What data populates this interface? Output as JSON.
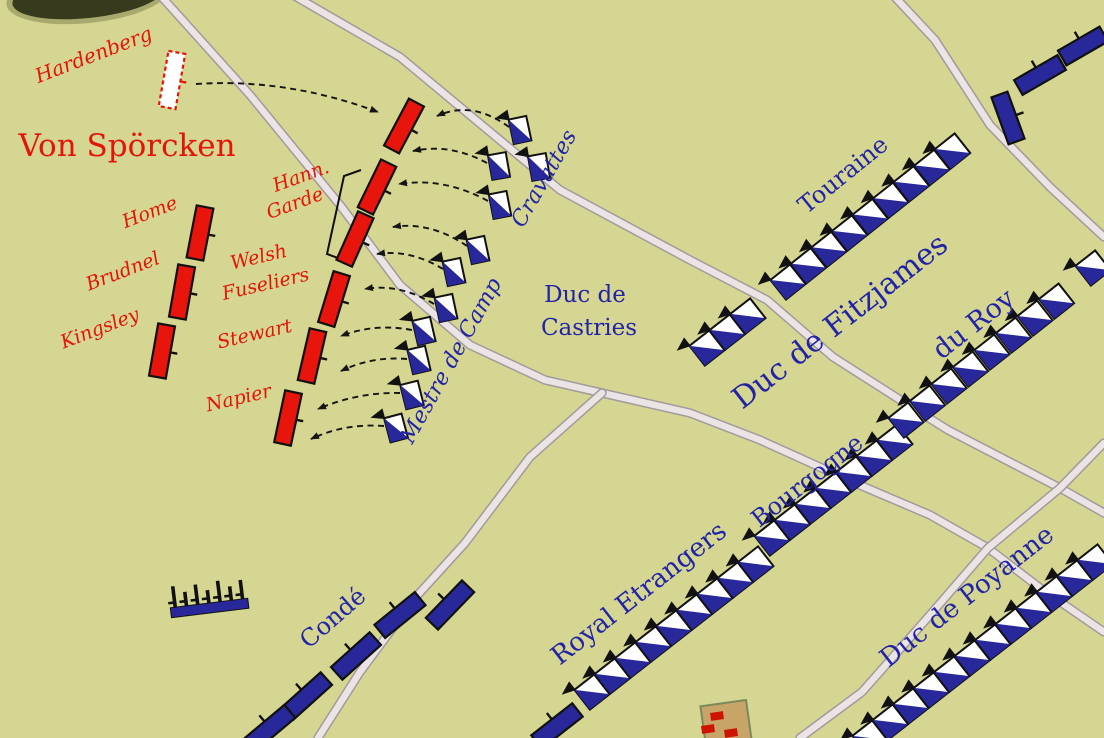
{
  "map": {
    "width": 1104,
    "height": 738,
    "colors": {
      "background": "#d4d691",
      "road_fill": "#ebe4e4",
      "road_edge": "#a29a9c",
      "red_unit": "#e8150c",
      "blue_unit": "#28289b",
      "red_text": "#e41408",
      "blue_text": "#2323a7",
      "outline": "#111111",
      "building_fill": "#c8a469",
      "building_edge": "#7a8a5a",
      "building_mark": "#cc1400",
      "woods_dark": "#373a1c",
      "woods_halo": "#8a8c55"
    },
    "roads": [
      {
        "id": "northwest",
        "points": [
          [
            160,
            -5
          ],
          [
            250,
            95
          ],
          [
            340,
            205
          ],
          [
            400,
            285
          ],
          [
            470,
            345
          ],
          [
            545,
            380
          ],
          [
            602,
            393
          ]
        ]
      },
      {
        "id": "east",
        "points": [
          [
            602,
            393
          ],
          [
            690,
            413
          ],
          [
            760,
            440
          ],
          [
            855,
            483
          ],
          [
            930,
            515
          ],
          [
            988,
            548
          ],
          [
            1040,
            588
          ],
          [
            1104,
            632
          ]
        ]
      },
      {
        "id": "south",
        "points": [
          [
            602,
            393
          ],
          [
            530,
            457
          ],
          [
            465,
            543
          ],
          [
            415,
            598
          ],
          [
            360,
            672
          ],
          [
            318,
            738
          ]
        ]
      },
      {
        "id": "middle-diagonal",
        "points": [
          [
            293,
            -5
          ],
          [
            400,
            57
          ],
          [
            560,
            190
          ],
          [
            690,
            260
          ],
          [
            767,
            300
          ],
          [
            833,
            357
          ],
          [
            905,
            403
          ],
          [
            948,
            430
          ],
          [
            1060,
            488
          ],
          [
            1104,
            513
          ]
        ]
      },
      {
        "id": "northeast",
        "points": [
          [
            893,
            -5
          ],
          [
            935,
            40
          ],
          [
            990,
            125
          ],
          [
            1050,
            187
          ],
          [
            1104,
            237
          ]
        ]
      },
      {
        "id": "southeast",
        "points": [
          [
            1104,
            443
          ],
          [
            1060,
            488
          ],
          [
            988,
            548
          ],
          [
            930,
            615
          ],
          [
            862,
            692
          ],
          [
            800,
            738
          ]
        ]
      }
    ],
    "woods_blob": {
      "cx": 88,
      "cy": -4,
      "rx": 76,
      "ry": 22,
      "angle": -6
    },
    "building": {
      "x": 726,
      "y": 723,
      "w": 46,
      "h": 40,
      "angle": -8,
      "marks": [
        {
          "x": 717,
          "y": 716,
          "w": 13,
          "h": 8,
          "angle": -8
        },
        {
          "x": 708,
          "y": 729,
          "w": 13,
          "h": 8,
          "angle": -8
        },
        {
          "x": 731,
          "y": 733,
          "w": 13,
          "h": 8,
          "angle": -8
        }
      ]
    },
    "bracket": {
      "points": "361,170 344,176 327,254 346,261"
    },
    "artillery": {
      "x": 209,
      "y": 603,
      "angle": -7,
      "bar_w": 78,
      "bar_h": 10,
      "teeth": [
        21,
        14,
        20,
        13,
        21,
        14,
        19
      ]
    },
    "units_infantry": [
      {
        "id": "hardenberg",
        "x": 172,
        "y": 80,
        "w": 17,
        "h": 56,
        "angle": 10,
        "variant": "ghost"
      },
      {
        "id": "line-north-1",
        "x": 404,
        "y": 126,
        "w": 17,
        "h": 53,
        "angle": 28,
        "variant": "red"
      },
      {
        "id": "hann-garde-1",
        "x": 377,
        "y": 187,
        "w": 17,
        "h": 53,
        "angle": 26,
        "variant": "red"
      },
      {
        "id": "hann-garde-2",
        "x": 355,
        "y": 239,
        "w": 17,
        "h": 53,
        "angle": 24,
        "variant": "red"
      },
      {
        "id": "welsh-fuseliers",
        "x": 334,
        "y": 299,
        "w": 17,
        "h": 53,
        "angle": 17,
        "variant": "red"
      },
      {
        "id": "stewart",
        "x": 312,
        "y": 356,
        "w": 17,
        "h": 53,
        "angle": 13,
        "variant": "red"
      },
      {
        "id": "napier",
        "x": 288,
        "y": 418,
        "w": 17,
        "h": 53,
        "angle": 12,
        "variant": "red"
      },
      {
        "id": "home",
        "x": 200,
        "y": 233,
        "w": 17,
        "h": 53,
        "angle": 11,
        "variant": "red"
      },
      {
        "id": "brudnel",
        "x": 182,
        "y": 292,
        "w": 17,
        "h": 53,
        "angle": 10,
        "variant": "red"
      },
      {
        "id": "kingsley",
        "x": 162,
        "y": 351,
        "w": 17,
        "h": 53,
        "angle": 10,
        "variant": "red"
      },
      {
        "id": "conde-1",
        "x": 450,
        "y": 605,
        "w": 52,
        "h": 17,
        "angle": -46,
        "variant": "blue"
      },
      {
        "id": "conde-2",
        "x": 400,
        "y": 615,
        "w": 52,
        "h": 17,
        "angle": -39,
        "variant": "blue"
      },
      {
        "id": "conde-3",
        "x": 356,
        "y": 656,
        "w": 52,
        "h": 17,
        "angle": -42,
        "variant": "blue"
      },
      {
        "id": "conde-4",
        "x": 307,
        "y": 696,
        "w": 52,
        "h": 17,
        "angle": -42,
        "variant": "blue"
      },
      {
        "id": "conde-5",
        "x": 270,
        "y": 728,
        "w": 52,
        "h": 17,
        "angle": -40,
        "variant": "blue"
      },
      {
        "id": "battalion-south",
        "x": 557,
        "y": 726,
        "w": 52,
        "h": 17,
        "angle": -38,
        "variant": "blue"
      },
      {
        "id": "northeast-1",
        "x": 1008,
        "y": 118,
        "w": 50,
        "h": 17,
        "angle": 70,
        "variant": "blue"
      },
      {
        "id": "northeast-2",
        "x": 1040,
        "y": 75,
        "w": 50,
        "h": 17,
        "angle": -30,
        "variant": "blue"
      },
      {
        "id": "northeast-3",
        "x": 1083,
        "y": 46,
        "w": 48,
        "h": 17,
        "angle": -30,
        "variant": "blue"
      }
    ],
    "cavalry_lines": [
      {
        "id": "touraine-a",
        "x": 707,
        "y": 348,
        "angle": -38,
        "count": 3,
        "spacing": 26
      },
      {
        "id": "touraine-b",
        "x": 788,
        "y": 282,
        "angle": -38.5,
        "count": 9,
        "spacing": 26.3
      },
      {
        "id": "royal-etrangers",
        "x": 592,
        "y": 692,
        "angle": -38,
        "count": 9,
        "spacing": 26
      },
      {
        "id": "bourgogne",
        "x": 772,
        "y": 538,
        "angle": -38,
        "count": 7,
        "spacing": 26
      },
      {
        "id": "du-roy",
        "x": 906,
        "y": 420,
        "angle": -38.3,
        "count": 8,
        "spacing": 27.4
      },
      {
        "id": "du-roy-b",
        "x": 1093,
        "y": 268,
        "angle": -38,
        "count": 1,
        "spacing": 26
      },
      {
        "id": "poyanne",
        "x": 870,
        "y": 738,
        "angle": -38,
        "count": 12,
        "spacing": 26
      }
    ],
    "cavalry_squadrons": [
      {
        "x": 520,
        "y": 130,
        "angle": -12
      },
      {
        "x": 539,
        "y": 167,
        "angle": -10
      },
      {
        "x": 499,
        "y": 166,
        "angle": -10
      },
      {
        "x": 500,
        "y": 205,
        "angle": -11
      },
      {
        "x": 478,
        "y": 250,
        "angle": -12
      },
      {
        "x": 454,
        "y": 272,
        "angle": -12
      },
      {
        "x": 446,
        "y": 308,
        "angle": -12
      },
      {
        "x": 424,
        "y": 331,
        "angle": -13
      },
      {
        "x": 419,
        "y": 360,
        "angle": -13
      },
      {
        "x": 412,
        "y": 395,
        "angle": -14
      },
      {
        "x": 396,
        "y": 428,
        "angle": -15
      }
    ],
    "arrows": [
      {
        "from": [
          196,
          84
        ],
        "ctrl": [
          287,
          78
        ],
        "to": [
          378,
          112
        ]
      },
      {
        "from": [
          509,
          127
        ],
        "ctrl": [
          472,
          100
        ],
        "to": [
          437,
          116
        ]
      },
      {
        "from": [
          487,
          163
        ],
        "ctrl": [
          450,
          143
        ],
        "to": [
          413,
          151
        ]
      },
      {
        "from": [
          488,
          201
        ],
        "ctrl": [
          444,
          177
        ],
        "to": [
          399,
          184
        ]
      },
      {
        "from": [
          467,
          246
        ],
        "ctrl": [
          430,
          221
        ],
        "to": [
          393,
          227
        ]
      },
      {
        "from": [
          443,
          269
        ],
        "ctrl": [
          410,
          249
        ],
        "to": [
          377,
          254
        ]
      },
      {
        "from": [
          434,
          304
        ],
        "ctrl": [
          399,
          283
        ],
        "to": [
          365,
          289
        ]
      },
      {
        "from": [
          412,
          330
        ],
        "ctrl": [
          375,
          323
        ],
        "to": [
          341,
          336
        ]
      },
      {
        "from": [
          407,
          359
        ],
        "ctrl": [
          372,
          356
        ],
        "to": [
          341,
          371
        ]
      },
      {
        "from": [
          400,
          393
        ],
        "ctrl": [
          358,
          392
        ],
        "to": [
          318,
          409
        ]
      },
      {
        "from": [
          384,
          426
        ],
        "ctrl": [
          345,
          423
        ],
        "to": [
          311,
          439
        ]
      }
    ],
    "labels": [
      {
        "id": "hardenberg",
        "text": "Hardenberg",
        "x": 96,
        "y": 61,
        "angle": -21,
        "size": 20,
        "color": "red",
        "italic": true
      },
      {
        "id": "von-spoercken",
        "text": "Von Spörcken",
        "x": 127,
        "y": 156,
        "angle": 0,
        "size": 31,
        "color": "red",
        "italic": false
      },
      {
        "id": "hann",
        "text": "Hann.",
        "x": 303,
        "y": 182,
        "angle": -20,
        "size": 19,
        "color": "red",
        "italic": true
      },
      {
        "id": "garde",
        "text": "Garde",
        "x": 297,
        "y": 209,
        "angle": -20,
        "size": 19,
        "color": "red",
        "italic": true
      },
      {
        "id": "home",
        "text": "Home",
        "x": 152,
        "y": 218,
        "angle": -21,
        "size": 19,
        "color": "red",
        "italic": true
      },
      {
        "id": "brudnel",
        "text": "Brudnel",
        "x": 125,
        "y": 277,
        "angle": -21,
        "size": 19,
        "color": "red",
        "italic": true
      },
      {
        "id": "kingsley",
        "text": "Kingsley",
        "x": 102,
        "y": 334,
        "angle": -21,
        "size": 19,
        "color": "red",
        "italic": true
      },
      {
        "id": "welsh",
        "text": "Welsh",
        "x": 260,
        "y": 263,
        "angle": -13,
        "size": 19,
        "color": "red",
        "italic": true
      },
      {
        "id": "fuseliers",
        "text": "Fuseliers",
        "x": 267,
        "y": 290,
        "angle": -13,
        "size": 19,
        "color": "red",
        "italic": true
      },
      {
        "id": "stewart",
        "text": "Stewart",
        "x": 256,
        "y": 340,
        "angle": -13,
        "size": 19,
        "color": "red",
        "italic": true
      },
      {
        "id": "napier",
        "text": "Napier",
        "x": 240,
        "y": 404,
        "angle": -13,
        "size": 19,
        "color": "red",
        "italic": true
      },
      {
        "id": "cravattes",
        "text": "Cravattes",
        "x": 550,
        "y": 182,
        "angle": -60,
        "size": 22,
        "color": "blue",
        "italic": true
      },
      {
        "id": "mestre-de-camp",
        "text": "Mestre de Camp",
        "x": 457,
        "y": 364,
        "angle": -61,
        "size": 22,
        "color": "blue",
        "italic": true
      },
      {
        "id": "duc-de",
        "text": "Duc de",
        "x": 585,
        "y": 302,
        "angle": 0,
        "size": 23,
        "color": "blue",
        "italic": false
      },
      {
        "id": "castries",
        "text": "Castries",
        "x": 589,
        "y": 335,
        "angle": 0,
        "size": 23,
        "color": "blue",
        "italic": false
      },
      {
        "id": "touraine",
        "text": "Touraine",
        "x": 848,
        "y": 181,
        "angle": -39,
        "size": 24,
        "color": "blue",
        "italic": false
      },
      {
        "id": "duc-de-fitzjames",
        "text": "Duc de Fitzjames",
        "x": 846,
        "y": 329,
        "angle": -38,
        "size": 30,
        "color": "blue",
        "italic": false
      },
      {
        "id": "du-roy",
        "text": "du Roy",
        "x": 979,
        "y": 331,
        "angle": -38,
        "size": 27,
        "color": "blue",
        "italic": false
      },
      {
        "id": "bourgogne",
        "text": "Bourgogne",
        "x": 812,
        "y": 487,
        "angle": -38,
        "size": 24,
        "color": "blue",
        "italic": false
      },
      {
        "id": "royal-etrangers",
        "text": "Royal Etrangers",
        "x": 644,
        "y": 600,
        "angle": -38,
        "size": 26,
        "color": "blue",
        "italic": false
      },
      {
        "id": "conde",
        "text": "Condé",
        "x": 338,
        "y": 624,
        "angle": -41,
        "size": 24,
        "color": "blue",
        "italic": false
      },
      {
        "id": "duc-de-poyanne",
        "text": "Duc de Poyanne",
        "x": 972,
        "y": 603,
        "angle": -38,
        "size": 26,
        "color": "blue",
        "italic": false
      }
    ]
  }
}
